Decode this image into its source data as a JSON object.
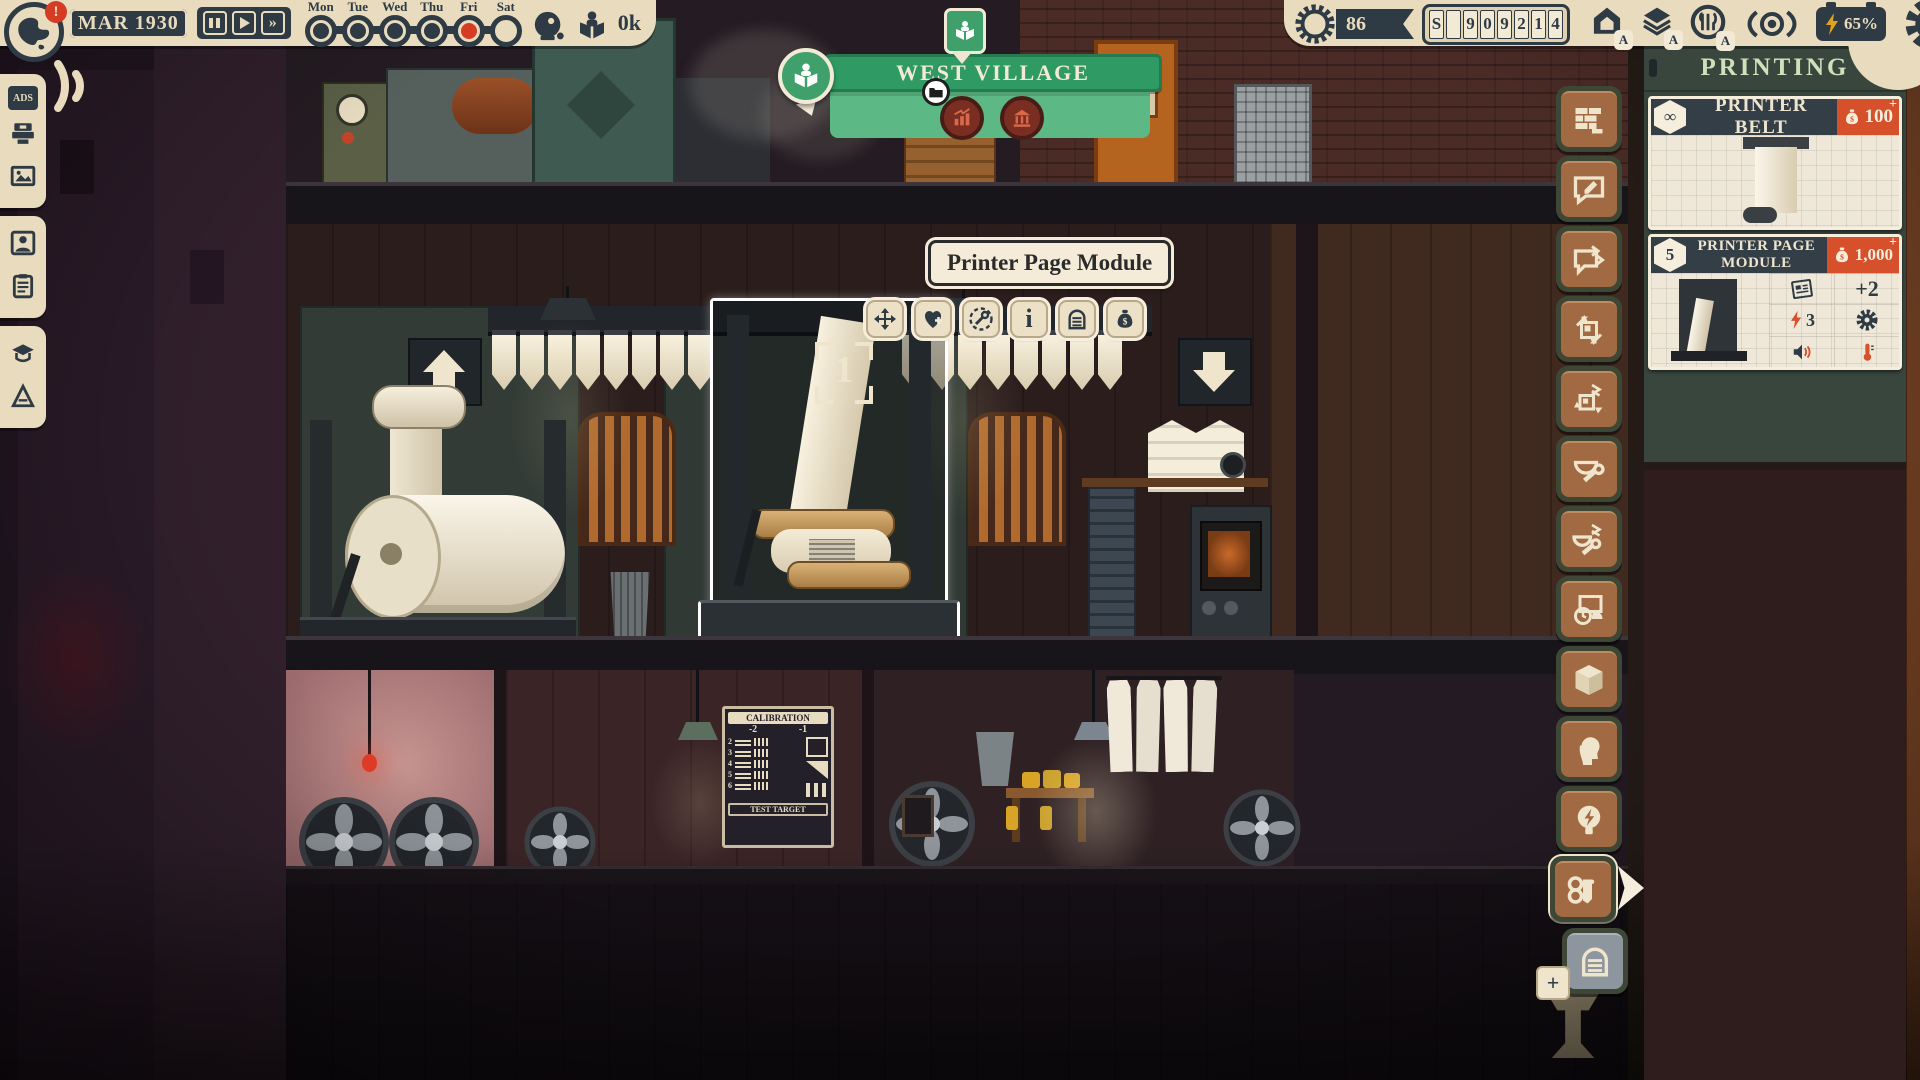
{
  "hud": {
    "date": "MAR 1930",
    "alert": "!",
    "readers": "0k",
    "days": [
      {
        "label": "Mon",
        "state": "done"
      },
      {
        "label": "Tue",
        "state": "done"
      },
      {
        "label": "Wed",
        "state": "done"
      },
      {
        "label": "Thu",
        "state": "done"
      },
      {
        "label": "Fri",
        "state": "current"
      },
      {
        "label": "Sat",
        "state": "todo"
      }
    ],
    "reputation": "86",
    "money": [
      "S",
      "",
      "9",
      "0",
      "9",
      "2",
      "1",
      "4"
    ],
    "power": "65%",
    "district_badges": [
      "A",
      "A",
      "A"
    ]
  },
  "location": {
    "title": "WEST VILLAGE"
  },
  "tooltip": {
    "title": "Printer Page Module"
  },
  "selection": {
    "marker": "1"
  },
  "sidebar": {
    "ads_label": "ADS"
  },
  "right_panel": {
    "title": "PRINTING",
    "cards": [
      {
        "badge": "∞",
        "title": "PRINTER BELT",
        "price": "100",
        "plus": "+"
      },
      {
        "badge": "5",
        "title": "PRINTER PAGE MODULE",
        "price": "1,000",
        "plus": "+",
        "stats": {
          "pages": "+2",
          "power": "3"
        }
      }
    ]
  },
  "poster": {
    "title": "CALIBRATION",
    "scale_left": "-2",
    "scale_right": "-1",
    "rows": [
      "2",
      "3",
      "4",
      "5",
      "6"
    ],
    "footer": "TEST TARGET"
  },
  "icons": {
    "infinity": "∞",
    "info": "i",
    "ff": "»",
    "plus": "+"
  }
}
